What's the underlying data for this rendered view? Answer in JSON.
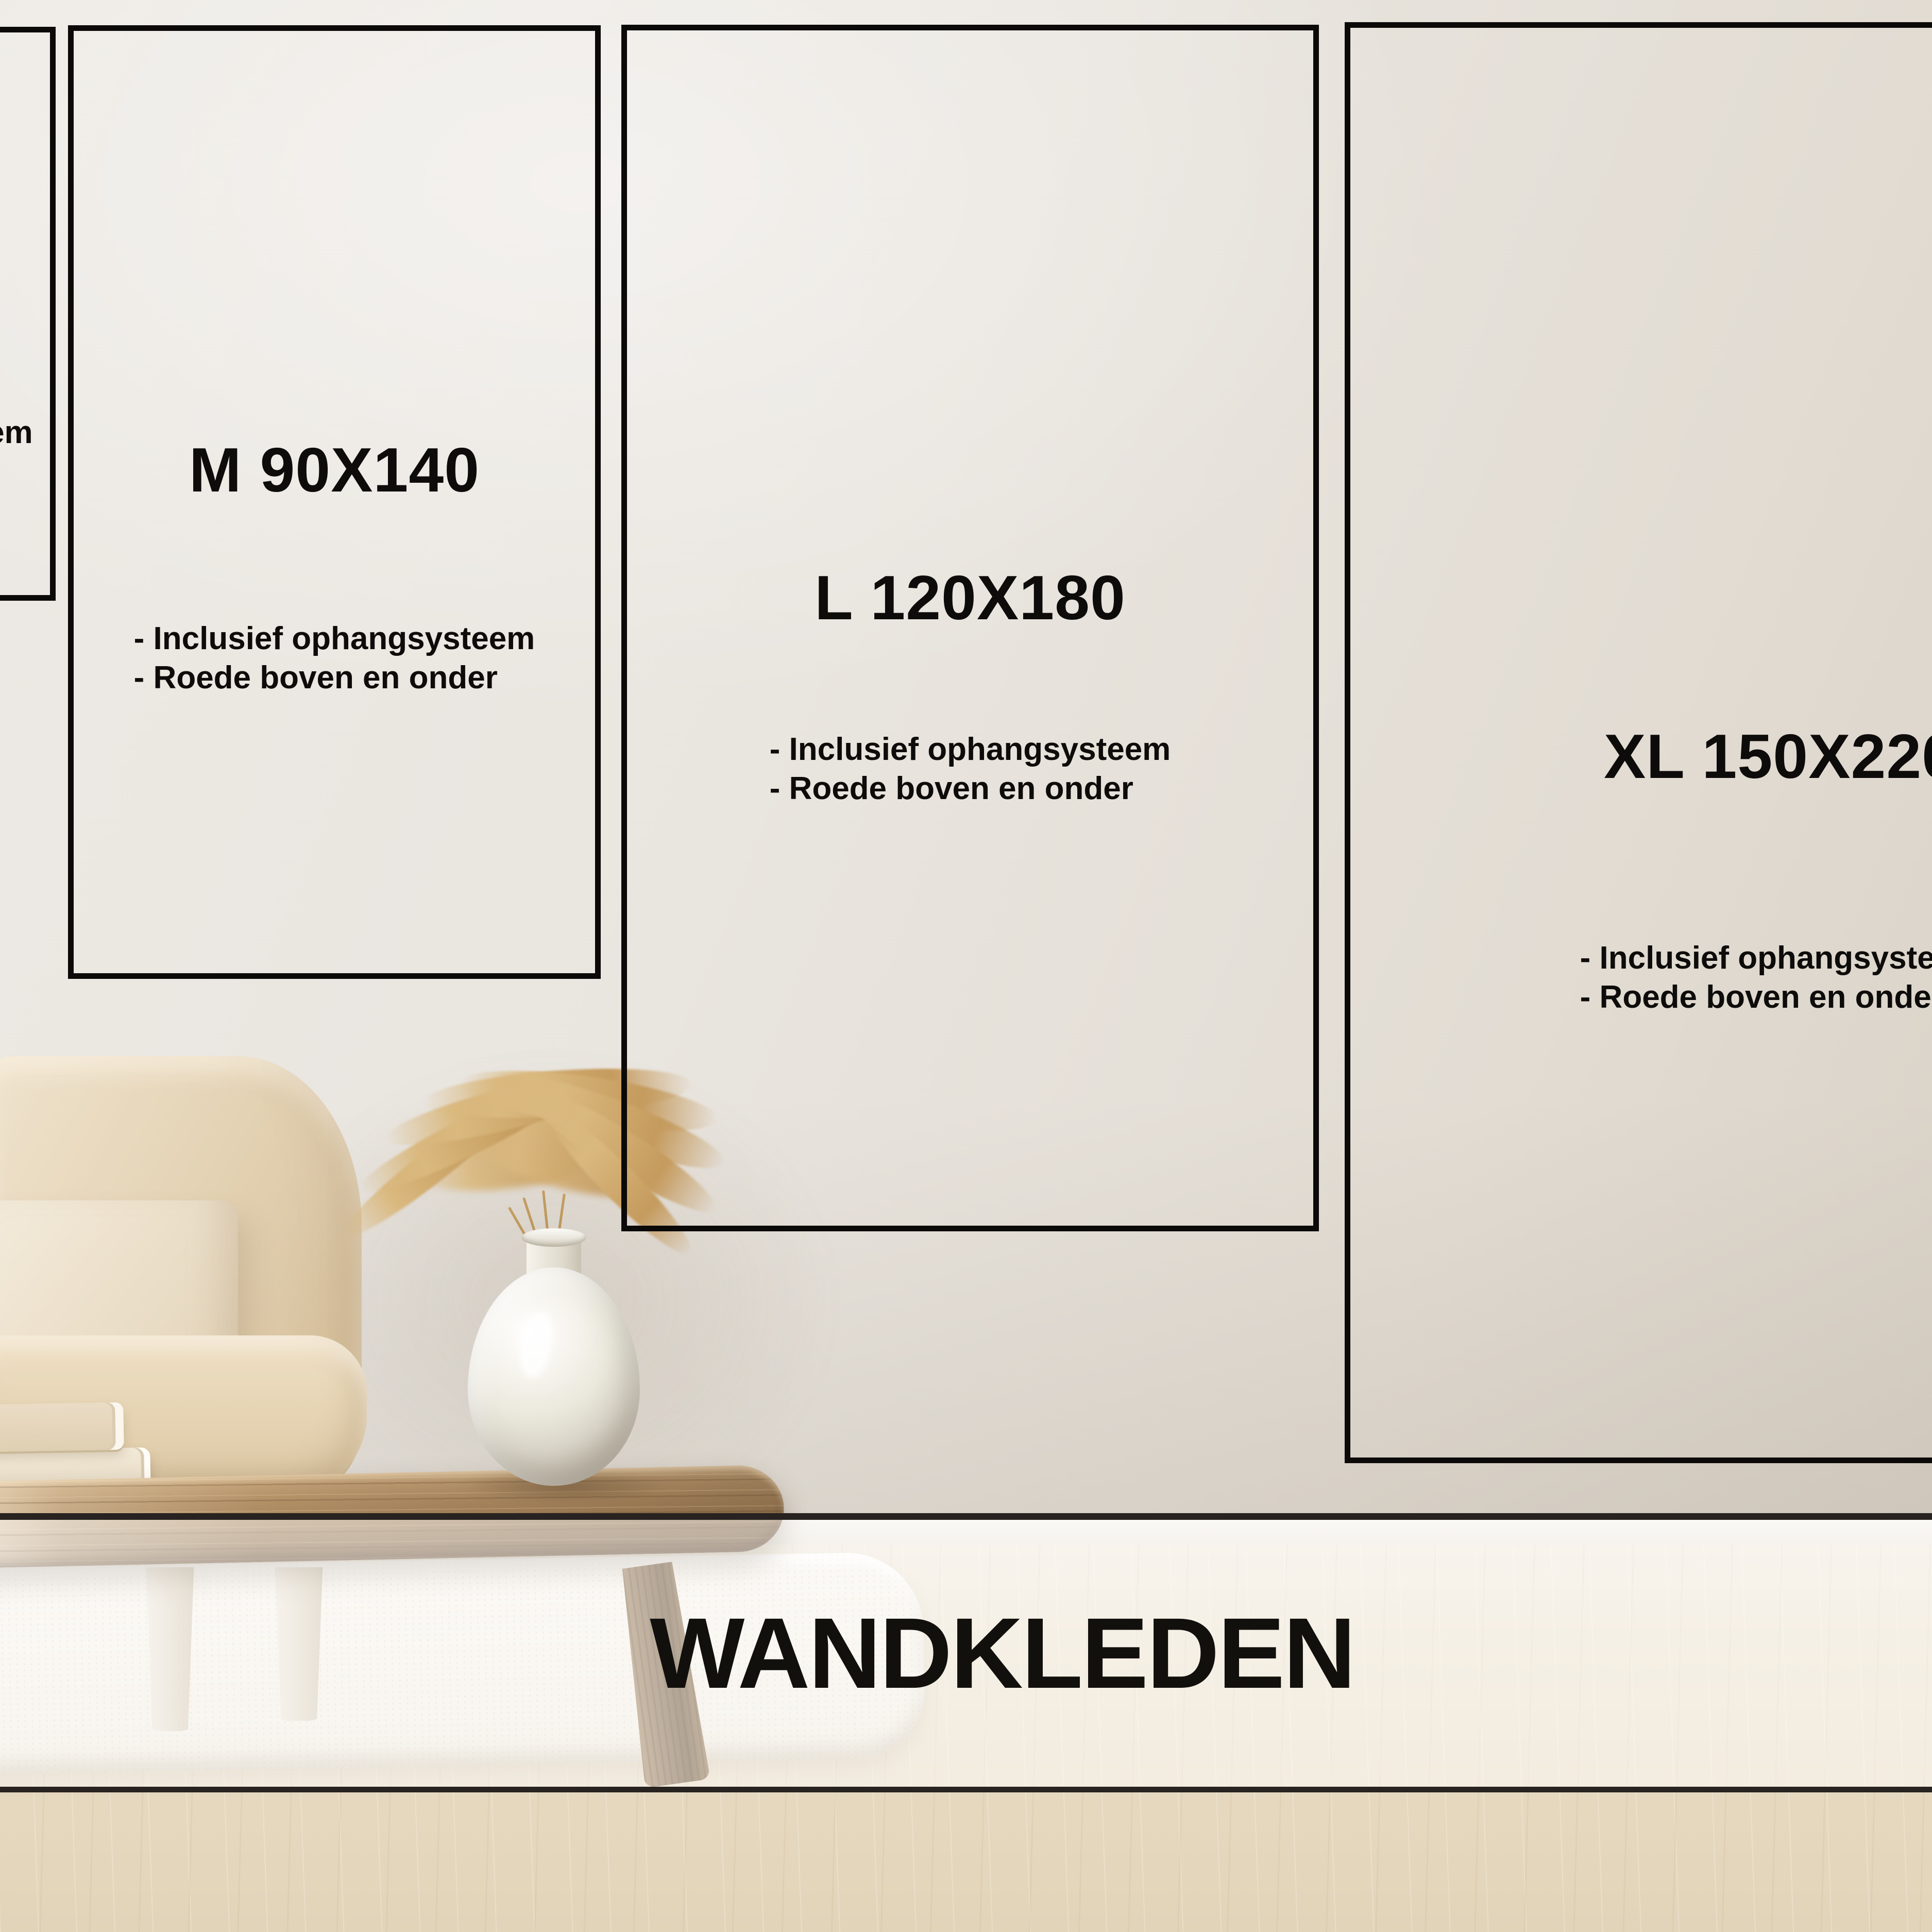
{
  "banner": {
    "title": "WANDKLEDEN"
  },
  "sizes": {
    "s": {
      "visible_fragment": "em"
    },
    "m": {
      "label": "M 90X140",
      "features": [
        "- Inclusief ophangsysteem",
        "- Roede boven en onder"
      ]
    },
    "l": {
      "label": "L 120X180",
      "features": [
        "- Inclusief ophangsysteem",
        "- Roede boven en onder"
      ]
    },
    "xl": {
      "label": "XL 150X220",
      "features": [
        "- Inclusief ophangsysteem",
        "- Roede boven en onder"
      ]
    }
  },
  "colors": {
    "box_border": "#0b0a09",
    "text": "#0d0c0a",
    "banner_text": "#12100d",
    "band_rule": "#282320",
    "wall": "#e8e4de",
    "floor": "#e6d9c0"
  }
}
